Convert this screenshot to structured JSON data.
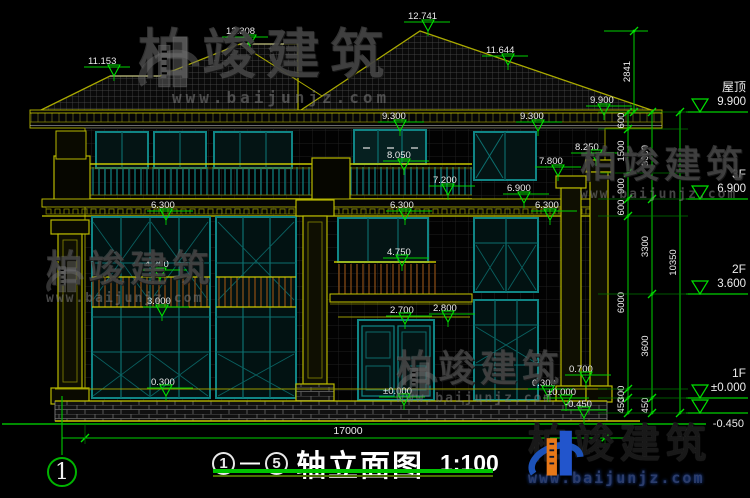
{
  "brand": {
    "name": "柏竣建筑",
    "url": "www.baijunjz.com"
  },
  "title": {
    "axis_start": "1",
    "dash": "—",
    "axis_end": "5",
    "label": "轴立面图",
    "scale": "1:100"
  },
  "axis_bubble": {
    "label": "1"
  },
  "annotations": {
    "markers": [
      {
        "v": "11.153",
        "lx": 88,
        "ly": 64,
        "tx": 114,
        "ty": 76
      },
      {
        "v": "12.308",
        "lx": 226,
        "ly": 34,
        "tx": 250,
        "ty": 46
      },
      {
        "v": "12.741",
        "lx": 408,
        "ly": 19,
        "tx": 428,
        "ty": 31
      },
      {
        "v": "11.644",
        "lx": 486,
        "ly": 53,
        "tx": 508,
        "ty": 65
      },
      {
        "v": "9.900",
        "lx": 590,
        "ly": 103,
        "tx": 604,
        "ty": 115
      },
      {
        "v": "9.300",
        "lx": 382,
        "ly": 119,
        "tx": 400,
        "ty": 131
      },
      {
        "v": "9.300",
        "lx": 520,
        "ly": 119,
        "tx": 538,
        "ty": 131
      },
      {
        "v": "8.250",
        "lx": 575,
        "ly": 150,
        "tx": 596,
        "ty": 161
      },
      {
        "v": "8.050",
        "lx": 387,
        "ly": 158,
        "tx": 404,
        "ty": 170
      },
      {
        "v": "7.800",
        "lx": 539,
        "ly": 164,
        "tx": 558,
        "ty": 176
      },
      {
        "v": "7.200",
        "lx": 433,
        "ly": 183,
        "tx": 448,
        "ty": 195
      },
      {
        "v": "6.900",
        "lx": 507,
        "ly": 191,
        "tx": 524,
        "ty": 203
      },
      {
        "v": "6.300",
        "lx": 151,
        "ly": 208,
        "tx": 166,
        "ty": 220
      },
      {
        "v": "6.300",
        "lx": 390,
        "ly": 208,
        "tx": 405,
        "ty": 220
      },
      {
        "v": "6.300",
        "lx": 535,
        "ly": 208,
        "tx": 550,
        "ty": 220
      },
      {
        "v": "4.750",
        "lx": 387,
        "ly": 255,
        "tx": 402,
        "ty": 266
      },
      {
        "v": "4.200",
        "lx": 145,
        "ly": 267,
        "tx": 160,
        "ty": 279
      },
      {
        "v": "3.000",
        "lx": 147,
        "ly": 304,
        "tx": 162,
        "ty": 316
      },
      {
        "v": "2.700",
        "lx": 390,
        "ly": 313,
        "tx": 405,
        "ty": 324
      },
      {
        "v": "2.800",
        "lx": 433,
        "ly": 311,
        "tx": 448,
        "ty": 322
      },
      {
        "v": "0.300",
        "lx": 151,
        "ly": 385,
        "tx": 166,
        "ty": 396
      },
      {
        "v": "±0.000",
        "lx": 383,
        "ly": 394,
        "tx": 404,
        "ty": 405
      },
      {
        "v": "0.700",
        "lx": 569,
        "ly": 372,
        "tx": 586,
        "ty": 383
      },
      {
        "v": "0.300",
        "lx": 532,
        "ly": 386,
        "tx": 548,
        "ty": 397
      },
      {
        "v": "±0.000",
        "lx": 547,
        "ly": 395,
        "tx": 566,
        "ty": 406
      },
      {
        "v": "-0.450",
        "lx": 565,
        "ly": 407,
        "tx": 584,
        "ty": 418
      }
    ],
    "floors": [
      {
        "name": "屋顶",
        "v": "9.900",
        "y": 112,
        "below": false
      },
      {
        "name": "3F",
        "v": "6.900",
        "y": 199,
        "below": false
      },
      {
        "name": "2F",
        "v": "3.600",
        "y": 294,
        "below": false
      },
      {
        "name": "1F",
        "v": "±0.000",
        "y": 398,
        "below": false
      },
      {
        "name": "",
        "v": "-0.450",
        "y": 413,
        "below": true
      }
    ],
    "chains": [
      {
        "x": 628,
        "bounds": [
          112,
          129,
          173,
          199,
          216,
          389,
          398,
          413
        ],
        "labels": [
          "600",
          "1500",
          "900",
          "600",
          "6000",
          "300",
          "450"
        ]
      },
      {
        "x": 652,
        "bounds": [
          112,
          199,
          294,
          398,
          413
        ],
        "labels": [
          "3000",
          "3300",
          "3600",
          "450"
        ]
      },
      {
        "x": 680,
        "bounds": [
          112,
          413
        ],
        "labels": [
          "10350"
        ]
      },
      {
        "x": 634,
        "bounds": [
          31,
          112
        ],
        "labels": [
          "2841"
        ]
      }
    ],
    "ext_levels": [
      112,
      129,
      173,
      199,
      216,
      294,
      389,
      398,
      413
    ],
    "width_dim": {
      "label": "17000",
      "y": 438,
      "x1": 62,
      "x2": 634,
      "t1": 85,
      "t2": 605
    }
  }
}
